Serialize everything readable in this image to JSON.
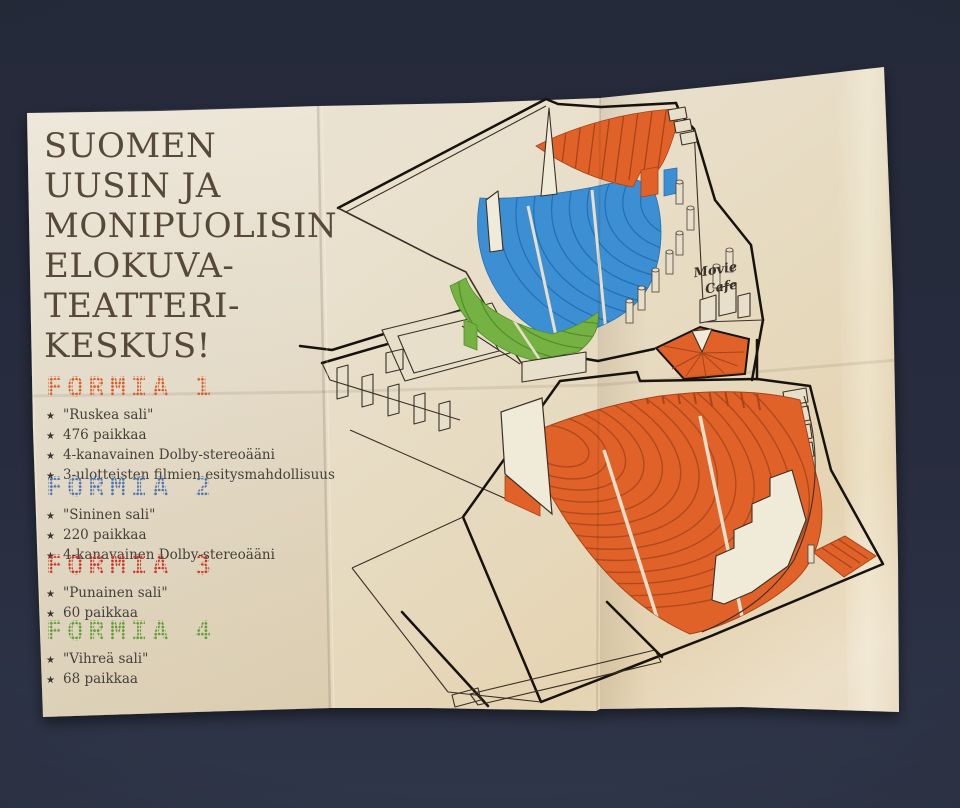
{
  "photo": {
    "table_color": "#272c3e",
    "paper_color": "#e8dfcb"
  },
  "poster": {
    "title_lines": [
      "SUOMEN",
      "UUSIN JA",
      "MONIPUOLISIN",
      "ELOKUVA-",
      "TEATTERI-",
      "KESKUS!"
    ],
    "title_color": "#57493a",
    "bullet_icon": "★",
    "sections": [
      {
        "heading": "FORMIA 1",
        "color": "#d85a26",
        "bullets": [
          "\"Ruskea sali\"",
          "476 paikkaa",
          "4-kanavainen Dolby-stereoääni",
          "3-ulotteisten filmien esitysmahdollisuus"
        ]
      },
      {
        "heading": "FORMIA 2",
        "color": "#4a74b0",
        "bullets": [
          "\"Sininen sali\"",
          "220 paikkaa",
          "4-kanavainen Dolby-stereoääni"
        ]
      },
      {
        "heading": "FORMIA 3",
        "color": "#c93527",
        "bullets": [
          "\"Punainen sali\"",
          "60 paikkaa"
        ]
      },
      {
        "heading": "FORMIA 4",
        "color": "#5f9e33",
        "bullets": [
          "\"Vihreä sali\"",
          "68 paikkaa"
        ]
      }
    ],
    "diagram": {
      "cafe_label_line1": "Movie",
      "cafe_label_line2": "Cafe",
      "hall_colors": {
        "formia1_orange": "#e06228",
        "formia2_blue": "#3d8fd4",
        "formia4_green": "#76b243"
      }
    }
  }
}
